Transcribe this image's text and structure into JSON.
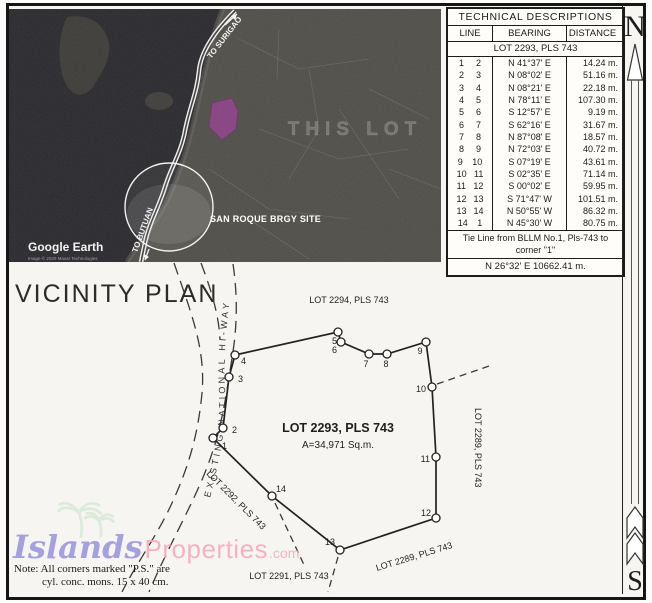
{
  "tech_table": {
    "title": "TECHNICAL DESCRIPTIONS",
    "col_line": "LINE",
    "col_bearing": "BEARING",
    "col_distance": "DISTANCE",
    "lot_header": "LOT 2293, PLS 743",
    "rows": [
      {
        "f": "1",
        "t": "2",
        "b": "N 41°37' E",
        "d": "14.24 m."
      },
      {
        "f": "2",
        "t": "3",
        "b": "N 08°02' E",
        "d": "51.16 m."
      },
      {
        "f": "3",
        "t": "4",
        "b": "N 08°21' E",
        "d": "22.18 m."
      },
      {
        "f": "4",
        "t": "5",
        "b": "N 78°11' E",
        "d": "107.30 m."
      },
      {
        "f": "5",
        "t": "6",
        "b": "S 12°57' E",
        "d": "9.19 m."
      },
      {
        "f": "6",
        "t": "7",
        "b": "S 62°16' E",
        "d": "31.67 m."
      },
      {
        "f": "7",
        "t": "8",
        "b": "N 87°08' E",
        "d": "18.57 m."
      },
      {
        "f": "8",
        "t": "9",
        "b": "N 72°03' E",
        "d": "40.72 m."
      },
      {
        "f": "9",
        "t": "10",
        "b": "S 07°19' E",
        "d": "43.61 m."
      },
      {
        "f": "10",
        "t": "11",
        "b": "S 02°35' E",
        "d": "71.14 m."
      },
      {
        "f": "11",
        "t": "12",
        "b": "S 00°02' E",
        "d": "59.95 m."
      },
      {
        "f": "12",
        "t": "13",
        "b": "S 71°47' W",
        "d": "101.51 m."
      },
      {
        "f": "13",
        "t": "14",
        "b": "N 50°55' W",
        "d": "86.32 m."
      },
      {
        "f": "14",
        "t": "1",
        "b": "N 45°30' W",
        "d": "80.75 m."
      }
    ],
    "tie_line1": "Tie Line from BLLM No.1, Pls-743 to",
    "tie_line2": "corner \"1\"",
    "tie_value": "N 26°32' E   10662.41 m."
  },
  "compass": {
    "north": "N",
    "south": "S"
  },
  "map": {
    "to_surigao": "TO SURIGAO",
    "to_butuan": "TO BUTUAN",
    "this_lot": "THIS LOT",
    "brgy_site": "SAN ROQUE BRGY SITE",
    "google_earth": "Google Earth",
    "copyright": "Image © 2020 Maxar Technologies"
  },
  "plan": {
    "title": "VICINITY PLAN",
    "lot_label": "LOT 2293, PLS 743",
    "area_label": "A=34,971 Sq.m.",
    "highway_label": "EXISTING NATIONAL HI-WAY",
    "lot2294": "LOT 2294, PLS 743",
    "lot2292": "LOT 2292, PLS 743",
    "lot2291": "LOT 2291, PLS 743",
    "lot2289_diag": "LOT 2289, PLS 743",
    "lot2289_vert": "LOT 2289, PLS 743",
    "corners": [
      "1",
      "2",
      "3",
      "4",
      "5",
      "6",
      "7",
      "8",
      "9",
      "10",
      "11",
      "12",
      "13",
      "14"
    ]
  },
  "note": {
    "line1": "Note: All corners marked \"P.S.\" are",
    "line2": "cyl. conc. mons. 15 x 40 cm."
  },
  "watermark": {
    "islands": "Islands",
    "properties": "Properties",
    "com": ".com",
    "islands_color": "#9c98dc",
    "properties_color": "#f6abbb",
    "palm_color": "#d4e8d2",
    "lot_fill_color": "#8b3e85"
  }
}
